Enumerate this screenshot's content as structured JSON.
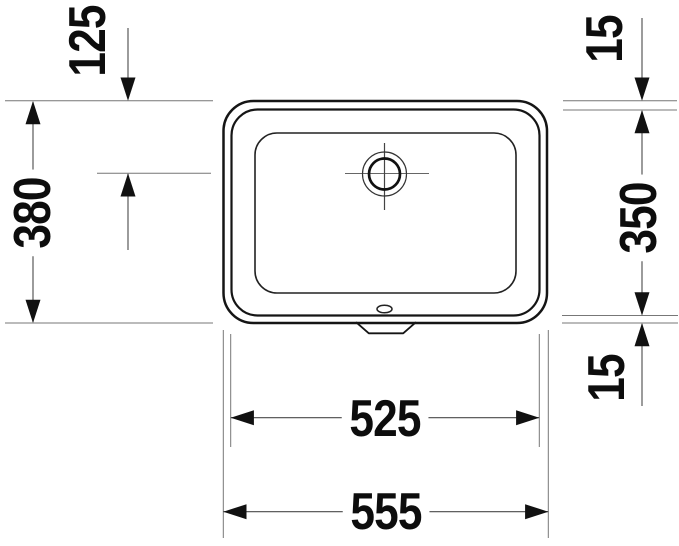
{
  "drawing": {
    "dimensions": {
      "drain_offset_from_top": "125",
      "overall_depth": "380",
      "rim_top": "15",
      "inner_depth": "350",
      "rim_bottom": "15",
      "inner_width": "525",
      "overall_width": "555"
    }
  }
}
